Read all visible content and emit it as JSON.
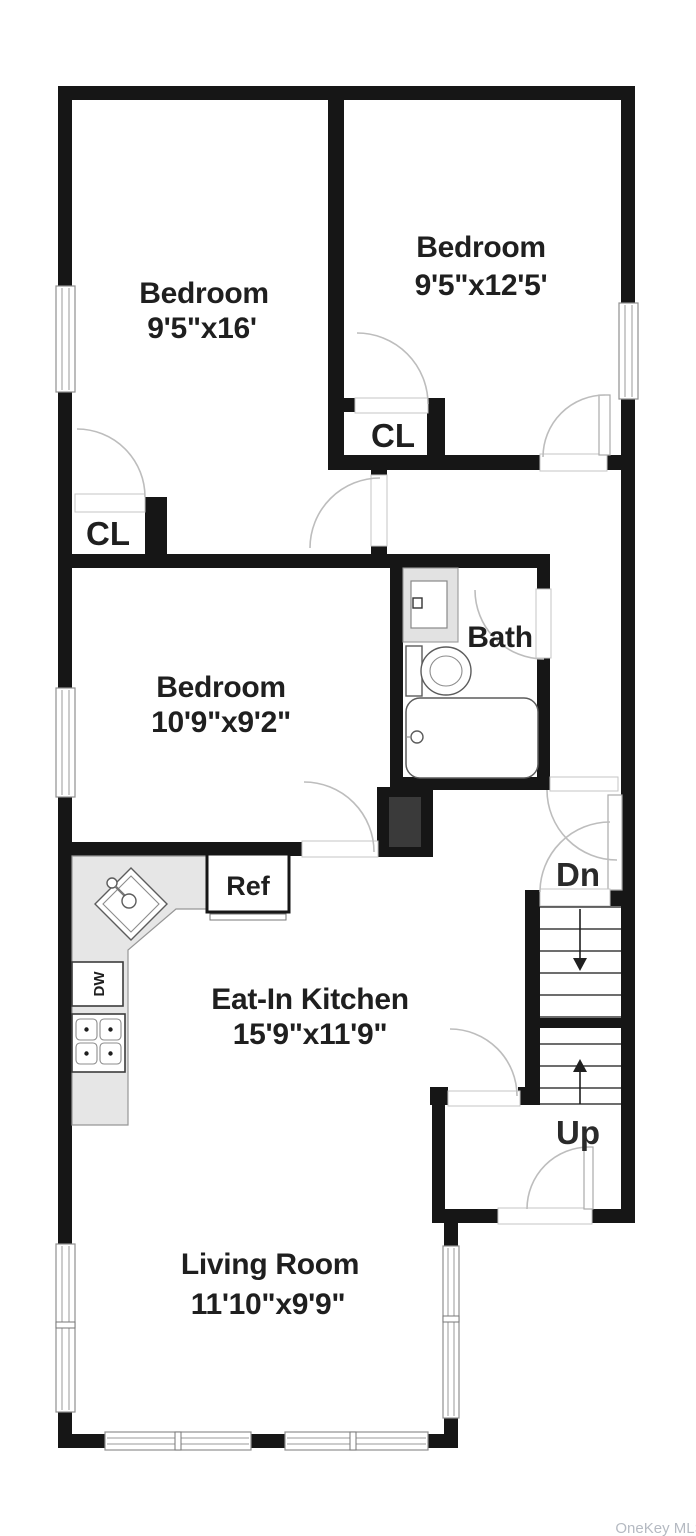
{
  "floorplan": {
    "watermark": "OneKey MLS",
    "rooms": {
      "bedroom_top_left": {
        "name": "Bedroom",
        "dims": "9'5\"x16'"
      },
      "bedroom_top_right": {
        "name": "Bedroom",
        "dims": "9'5\"x12'5'"
      },
      "bedroom_middle": {
        "name": "Bedroom",
        "dims": "10'9\"x9'2\""
      },
      "bath": {
        "name": "Bath"
      },
      "kitchen": {
        "name": "Eat-In Kitchen",
        "dims": "15'9\"x11'9\""
      },
      "living_room": {
        "name": "Living Room",
        "dims": "11'10\"x9'9\""
      }
    },
    "closets": {
      "upper": "CL",
      "lower": "CL"
    },
    "stairs": {
      "down": "Dn",
      "up": "Up"
    },
    "appliances": {
      "refrigerator": "Ref",
      "dishwasher": "DW"
    },
    "fixture_icons": [
      "sink-icon",
      "toilet-icon",
      "bathtub-icon",
      "stove-icon",
      "refrigerator-icon",
      "dishwasher-icon",
      "stairs-down-icon",
      "stairs-up-icon"
    ],
    "colors": {
      "wall": "#161616",
      "counter": "#e6e6e6",
      "door_arc": "#bdbdbd",
      "text": "#1f1f1f",
      "watermark": "#b5bac2"
    }
  }
}
